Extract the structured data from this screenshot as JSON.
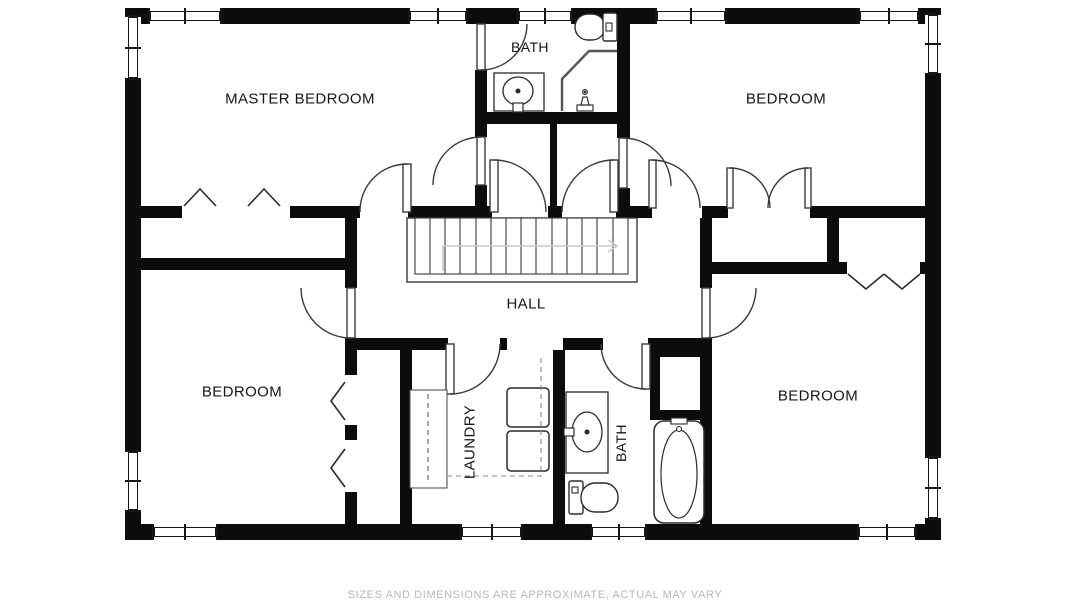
{
  "plan": {
    "rooms": [
      {
        "id": "master-bedroom",
        "label": "MASTER BEDROOM"
      },
      {
        "id": "bath-top",
        "label": "BATH"
      },
      {
        "id": "bedroom-top-right",
        "label": "BEDROOM"
      },
      {
        "id": "hall",
        "label": "HALL"
      },
      {
        "id": "bedroom-bottom-left",
        "label": "BEDROOM"
      },
      {
        "id": "laundry",
        "label": "LAUNDRY"
      },
      {
        "id": "bath-bottom",
        "label": "BATH"
      },
      {
        "id": "bedroom-bottom-right",
        "label": "BEDROOM"
      }
    ],
    "disclaimer": "SIZES AND DIMENSIONS ARE APPROXIMATE, ACTUAL MAY VARY",
    "colors": {
      "wall": "#0c0c0c",
      "line": "#3a3a3a",
      "stair_arrow": "#c9c9c9",
      "label_text": "#161616",
      "disclaimer_text": "#b8b8b8",
      "background": "#ffffff"
    }
  }
}
